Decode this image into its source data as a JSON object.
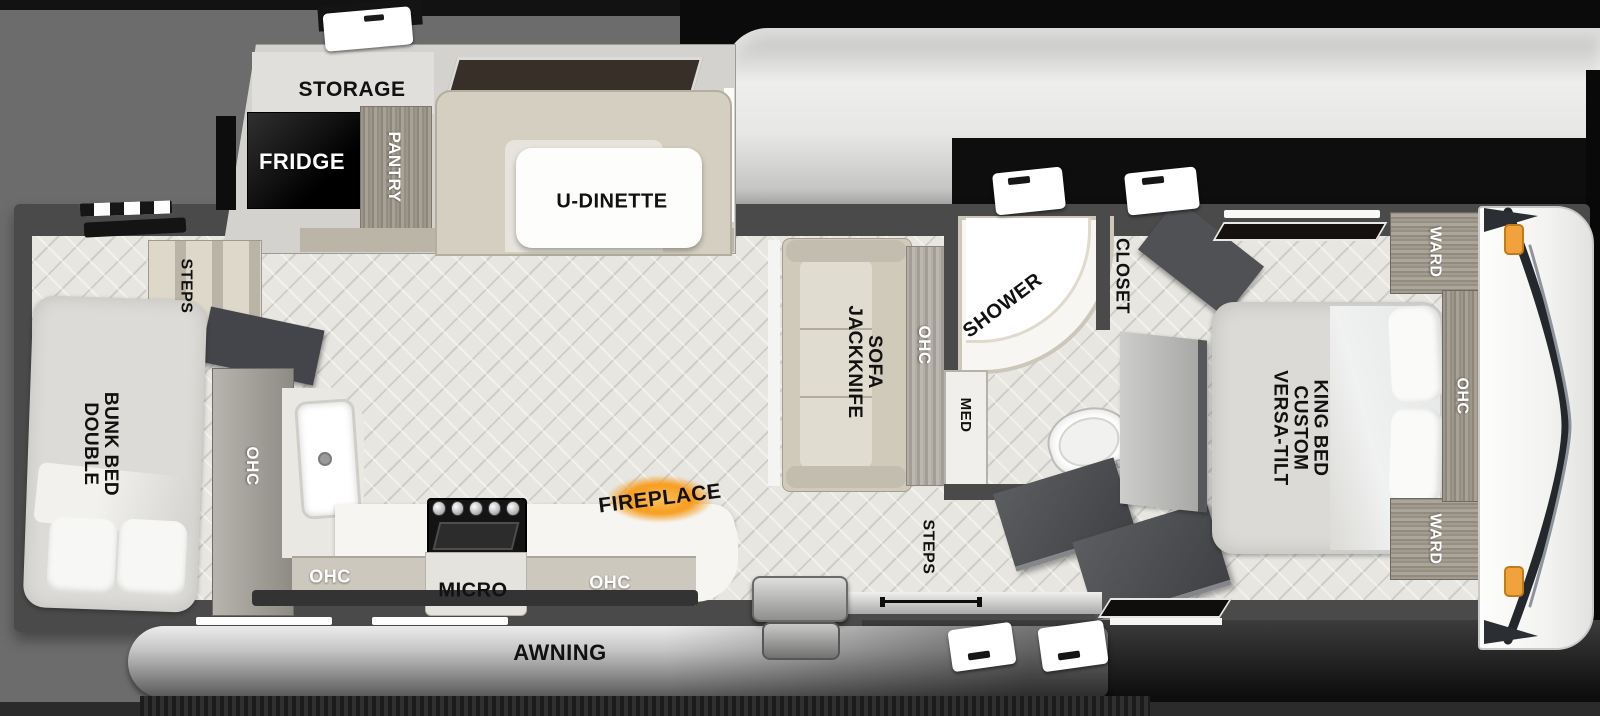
{
  "diagram": {
    "type": "rv-floorplan",
    "background_color": "#6c6c6c",
    "fireplace_glow_color": "#f79c1d",
    "marker_light_color": "#f2a23c"
  },
  "labels": {
    "storage": "STORAGE",
    "fridge": "FRIDGE",
    "pantry": "PANTRY",
    "u_dinette": "U-DINETTE",
    "jackknife_sofa": {
      "lines": [
        "JACKKNIFE",
        "SOFA"
      ]
    },
    "ohc_sofa": "OHC",
    "shower": "SHOWER",
    "med": "MED",
    "closet": "CLOSET",
    "ward_top": "WARD",
    "ward_bottom": "WARD",
    "ohc_bedroom": "OHC",
    "king_bed": {
      "lines": [
        "VERSA-TILT",
        "CUSTOM",
        "KING BED"
      ]
    },
    "double_bunk_bed": {
      "lines": [
        "DOUBLE",
        "BUNK BED"
      ]
    },
    "steps_rear": "STEPS",
    "steps_entry": "STEPS",
    "ohc_kitchen_tall": "OHC",
    "ohc_kitchen_left": "OHC",
    "micro": "MICRO",
    "ohc_kitchen_right": "OHC",
    "fireplace": "FIREPLACE",
    "awning": "AWNING"
  }
}
